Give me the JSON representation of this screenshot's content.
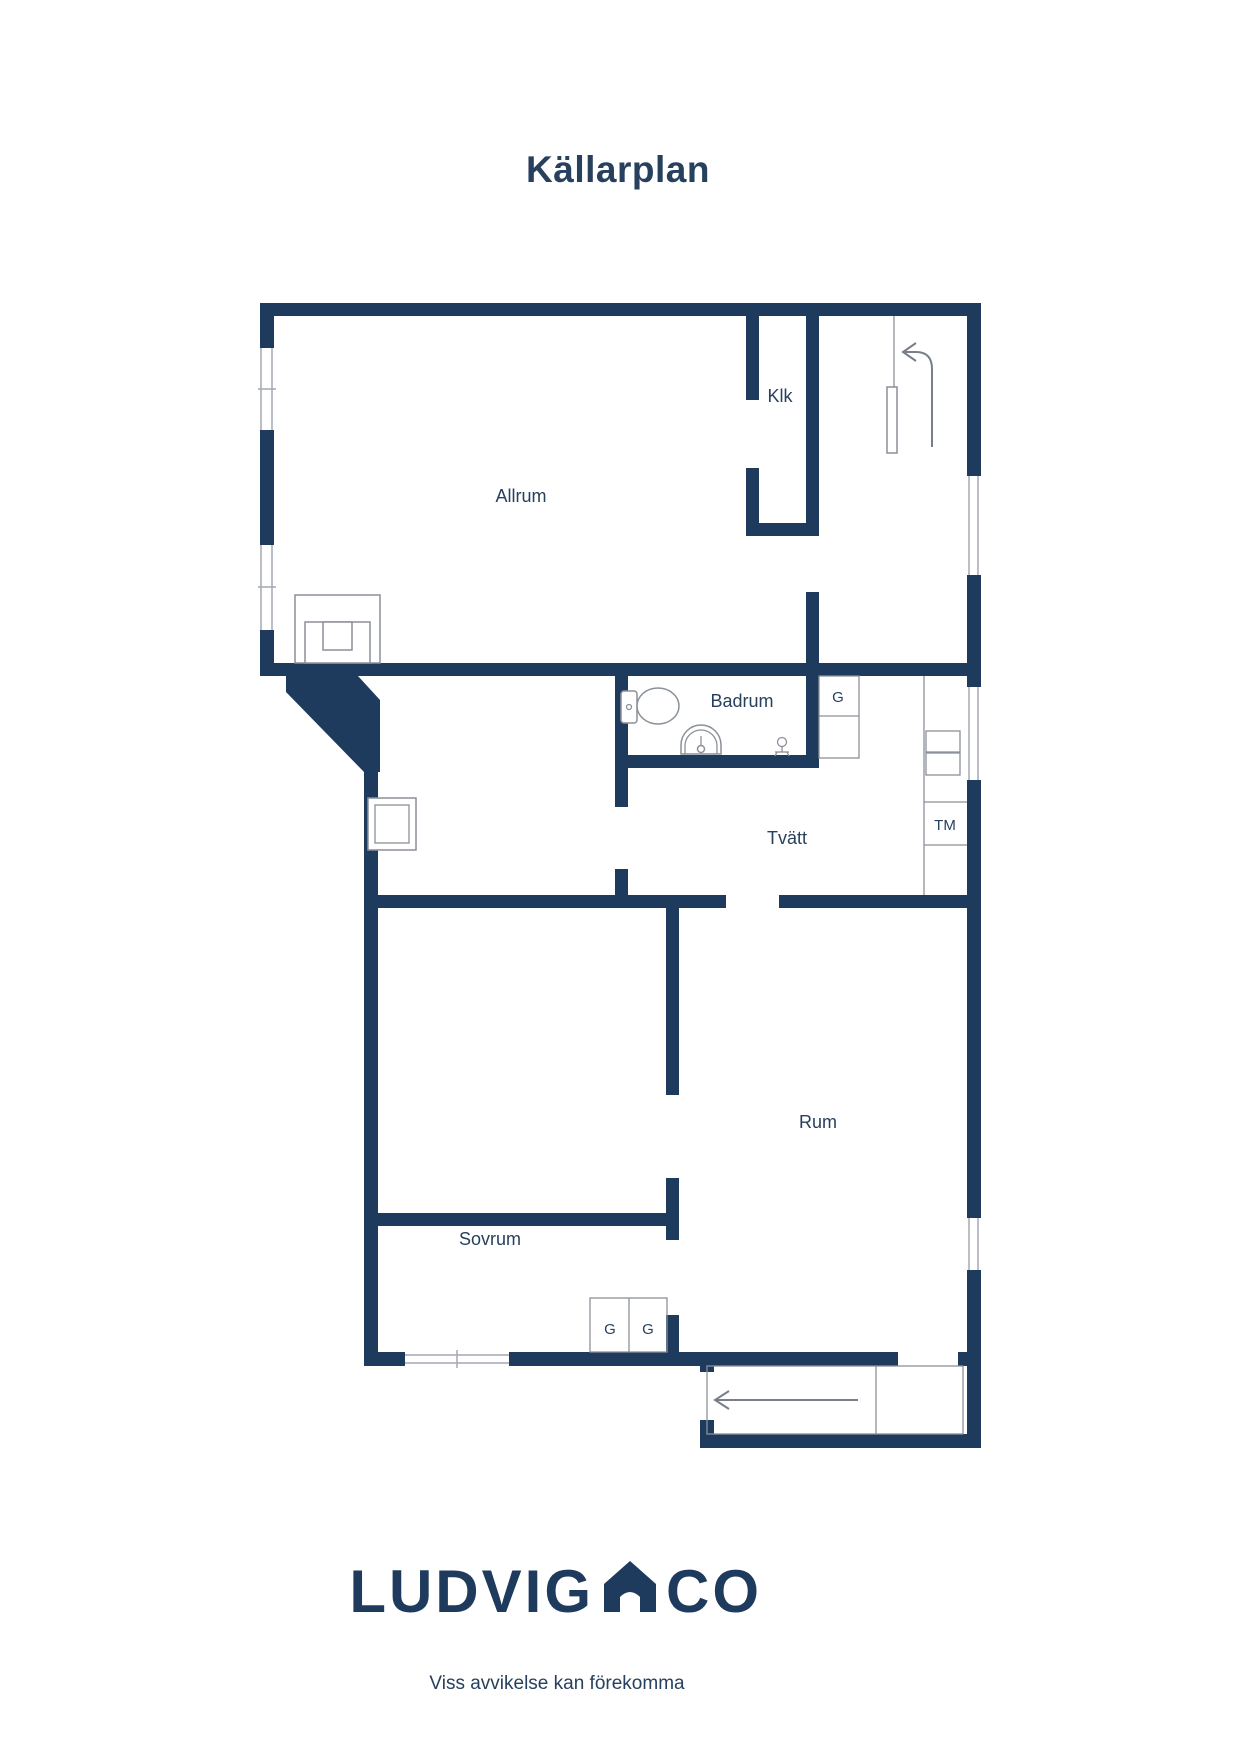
{
  "title": "Källarplan",
  "colors": {
    "wall": "#1e3a5c",
    "text": "#27405e",
    "outline": "#8b9199",
    "window_line": "#a4a9b0",
    "arrow": "#787f88"
  },
  "rooms": {
    "allrum": "Allrum",
    "klk": "Klk",
    "badrum": "Badrum",
    "tvatt": "Tvätt",
    "rum": "Rum",
    "sovrum": "Sovrum"
  },
  "closets": {
    "g_upper": "G",
    "g_left": "G",
    "g_right": "G",
    "tm": "TM"
  },
  "icons": {
    "toilet": "toilet-icon",
    "sink": "sink-icon",
    "floor_drain": "floor-drain-icon",
    "fireplace": "fireplace-icon",
    "stairs_up_arrow": "stairs-up-arrow-icon",
    "stairs_down_arrow": "stairs-down-arrow-icon",
    "house_logo": "house-logo-icon"
  },
  "footer": {
    "brand_left": "LUDVIG",
    "brand_right": "CO",
    "disclaimer": "Viss avvikelse kan förekomma"
  }
}
